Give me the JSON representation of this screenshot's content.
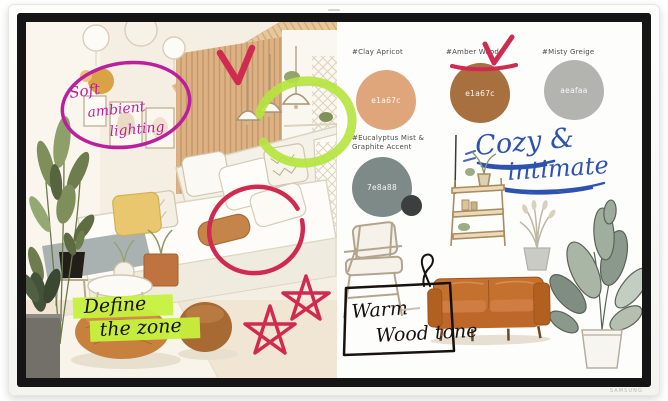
{
  "device": {
    "brand_label": "SAMSUNG"
  },
  "palette": {
    "marker_magenta": "#bb1f9f",
    "marker_red": "#d02a50",
    "marker_green": "#b5e43d",
    "highlighter_green": "#c6f13d",
    "ink_blue": "#2d52b0",
    "ink_black": "#17120e"
  },
  "swatches": [
    {
      "label": "#Clay Apricot",
      "hex": "e1a67c",
      "color": "#dfa57b"
    },
    {
      "label": "#Amber Wood",
      "hex": "e1a67c",
      "color": "#a8703f"
    },
    {
      "label": "#Misty Greige",
      "hex": "aeafaa",
      "color": "#b3b4af"
    },
    {
      "label": "#Eucalyptus Mist &",
      "label2": "Graphite Accent",
      "hex": "7e8a88",
      "color": "#7e8a88",
      "accent_color": "#3b3f3e"
    }
  ],
  "notes": {
    "soft": [
      "Soft",
      "ambient",
      "lighting"
    ],
    "define": [
      "Define",
      "the zone"
    ],
    "cozy": [
      "Cozy &",
      "intimate"
    ],
    "warm": [
      "Warm",
      "Wood tone"
    ]
  }
}
